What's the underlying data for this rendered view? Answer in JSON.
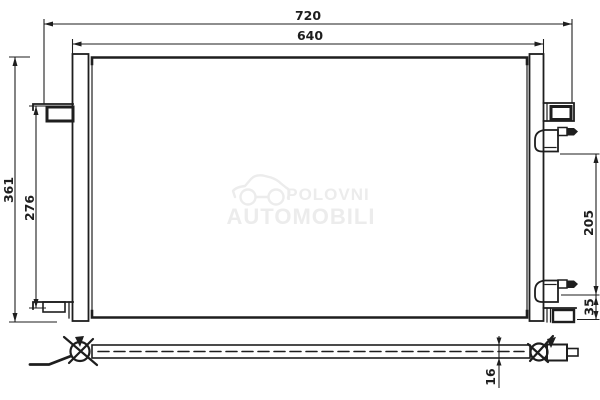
{
  "drawing": {
    "dimensions": {
      "overall_width": "720",
      "core_width": "640",
      "overall_height": "361",
      "mount_span": "276",
      "port_span": "205",
      "port_offset": "35",
      "core_depth": "16"
    },
    "watermark": {
      "line1": "POLOVNI",
      "line2": "AUTOMOBILI"
    },
    "colors": {
      "line": "#1e1e1e",
      "watermark": "#ececec",
      "background": "#ffffff"
    }
  }
}
